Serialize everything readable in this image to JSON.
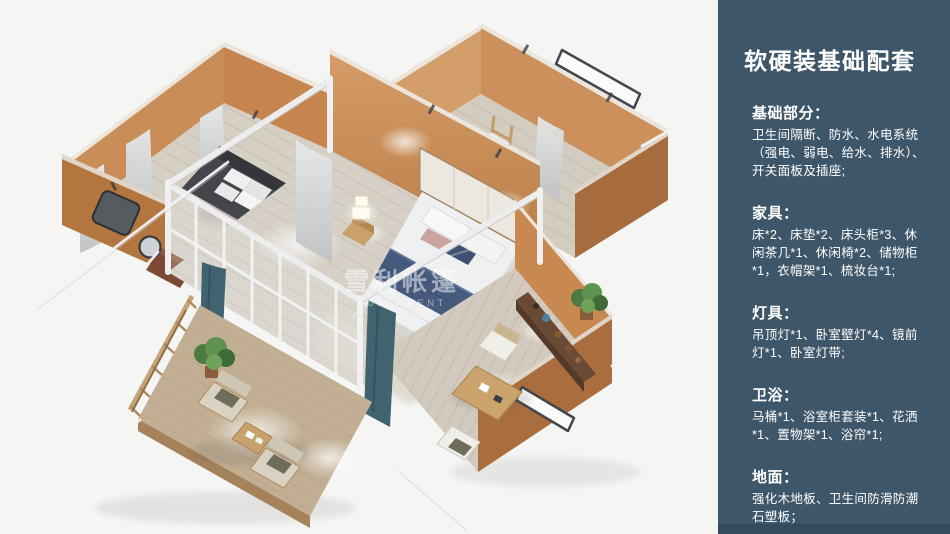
{
  "scene": {
    "watermark": {
      "cn": "雪利帐篷",
      "en": "XUELI TENT"
    }
  },
  "sidebar": {
    "title": "软硬装基础配套",
    "sections": [
      {
        "heading": "基础部分：",
        "body": "卫生间隔断、防水、水电系统（强电、弱电、给水、排水）、开关面板及插座;"
      },
      {
        "heading": "家具：",
        "body": "床*2、床垫*2、床头柜*3、休闲茶几*1、休闲椅*2、储物柜*1，衣帽架*1、梳妆台*1;"
      },
      {
        "heading": "灯具：",
        "body": "吊顶灯*1、卧室壁灯*4、镜前灯*1、卧室灯带;"
      },
      {
        "heading": "卫浴：",
        "body": "马桶*1、浴室柜套装*1、花洒*1、置物架*1、浴帘*1;"
      },
      {
        "heading": "地面：",
        "body": "强化木地板、卫生间防滑防潮石塑板；"
      }
    ]
  },
  "colors": {
    "sidebar_background": "#3e5669",
    "sidebar_text": "#ffffff",
    "scene_background": "#f5f5f4",
    "wall_orange_lit": "#cb905c",
    "wall_orange_shaded": "#a76c3d",
    "frame_white": "#ededee",
    "floor_wood": "#d6d0c6",
    "deck_wood": "#c2ae93",
    "bed_blanket_navy": "#455a7c",
    "curtain_teal": "#41636f",
    "plant_green": "#5f9150"
  }
}
